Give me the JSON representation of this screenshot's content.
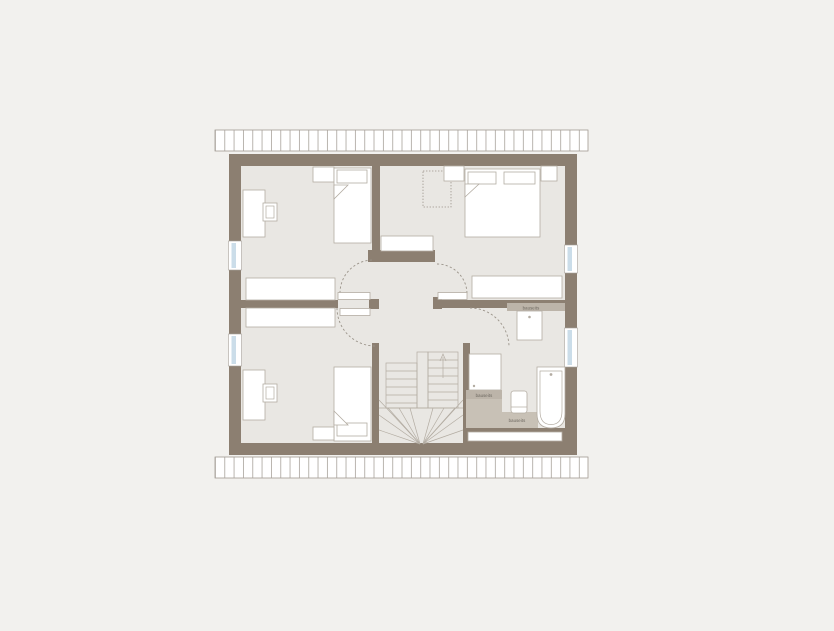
{
  "meta": {
    "view": "attic-storey-floor-plan",
    "style": "architectural line drawing on neutral background"
  },
  "colors": {
    "bg": "#f2f1ee",
    "floor": "#e9e7e3",
    "wall": "#8c7f71",
    "outline": "#b3aca2",
    "dash": "#9a9389",
    "glass": "#cbdde9",
    "tile": "#c8c1b6",
    "tile-dark": "#bcb4a9",
    "ink": "#6b665e",
    "hatch-line": "#a8a29b"
  },
  "labels": {
    "vanity_note": "bauseits",
    "shower_note": "bauseits",
    "bath_floor_note": "bauseits"
  },
  "inventory": {
    "rooms_visible": 5,
    "fixtures": [
      "single-bed",
      "double-bed",
      "desk",
      "chair",
      "wardrobe",
      "nightstand",
      "sideboard",
      "shower",
      "washbasin",
      "wc",
      "bathtub",
      "u-stair-with-winders"
    ],
    "openings": [
      "4 windows",
      "4 door swings",
      "roof eaves hatching top and bottom"
    ]
  }
}
